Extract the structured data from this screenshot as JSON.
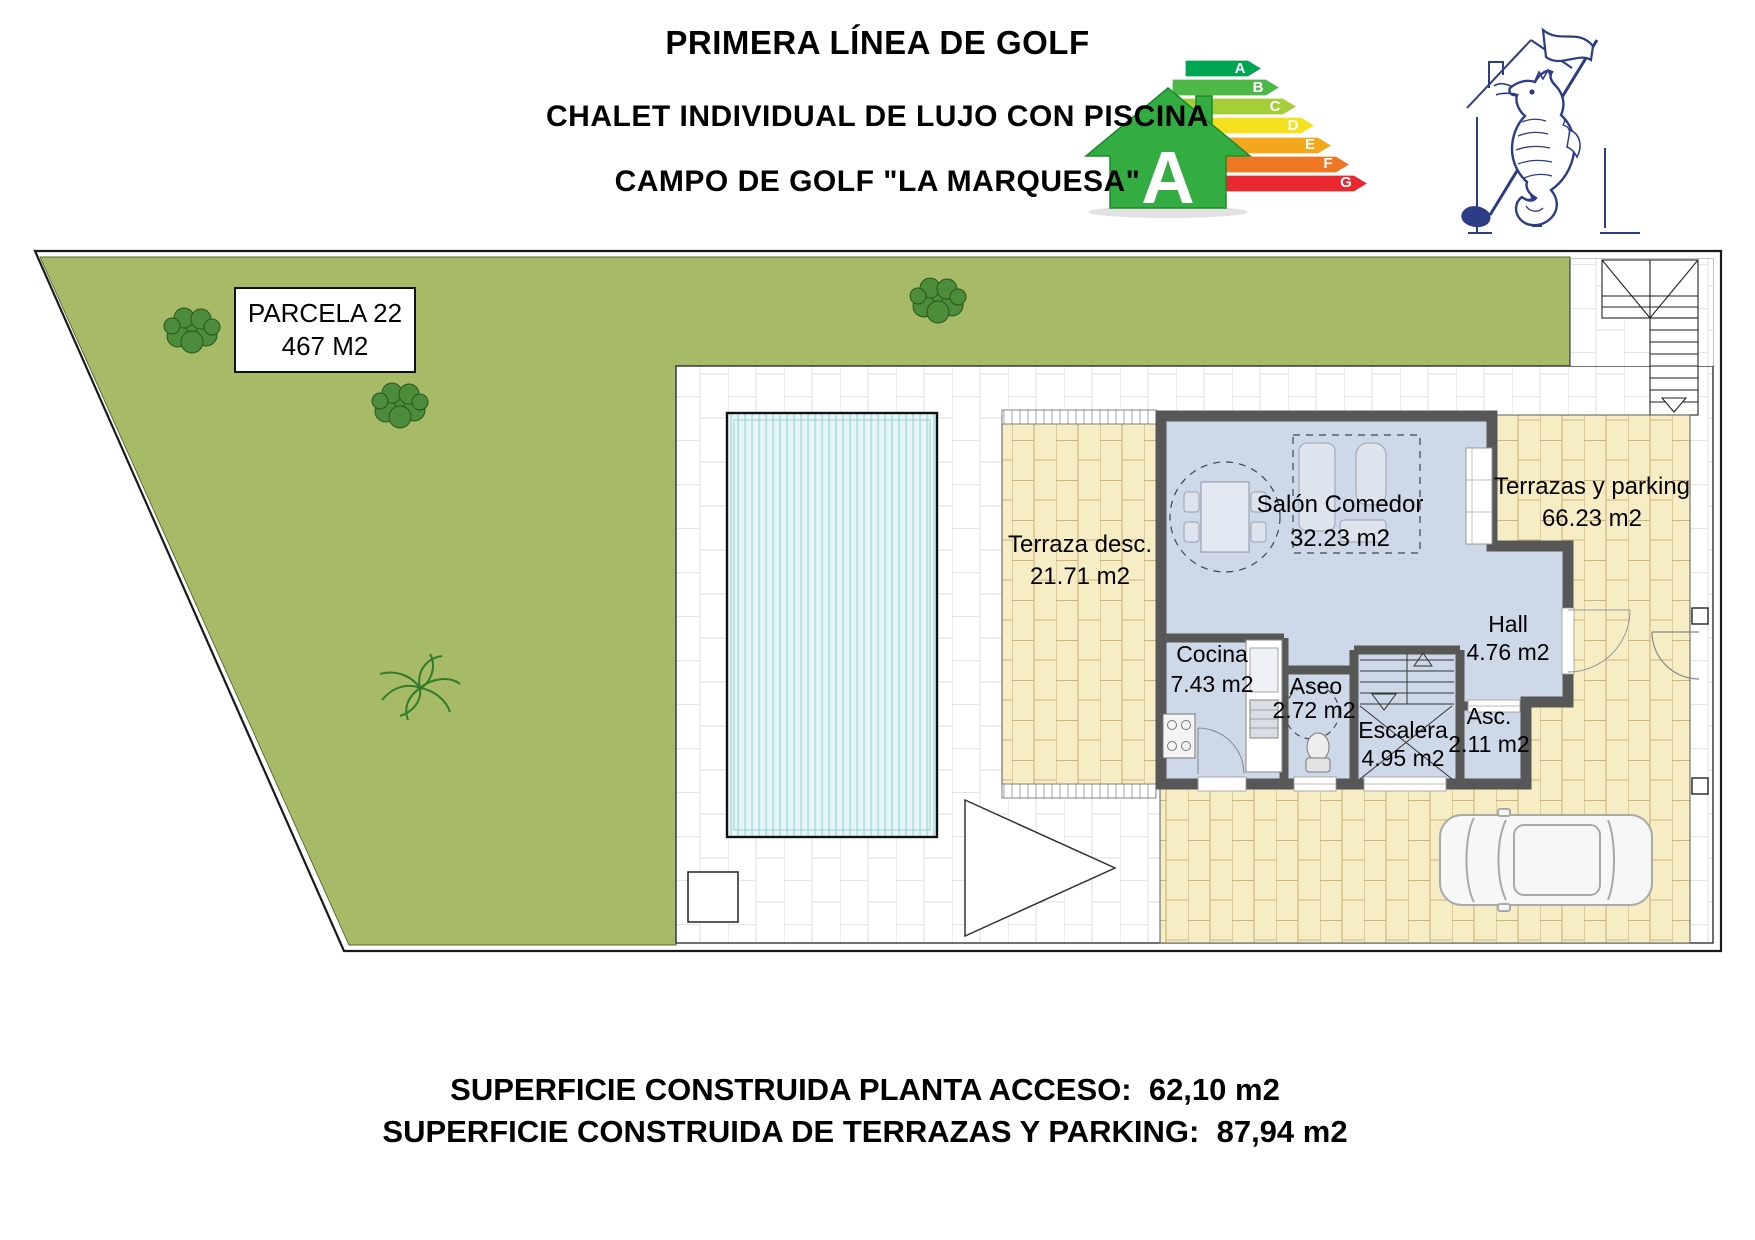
{
  "header": {
    "title_line1": "PRIMERA LÍNEA DE GOLF",
    "title_line2": "CHALET INDIVIDUAL DE LUJO CON PISCINA",
    "title_line3": "CAMPO DE GOLF \"LA MARQUESA\""
  },
  "energy_label": {
    "rating": "A",
    "bars": [
      {
        "label": "A",
        "color": "#00a551"
      },
      {
        "label": "B",
        "color": "#4db848"
      },
      {
        "label": "C",
        "color": "#a6ce39"
      },
      {
        "label": "D",
        "color": "#f4e01f"
      },
      {
        "label": "E",
        "color": "#f2a71d"
      },
      {
        "label": "F",
        "color": "#ef7622"
      },
      {
        "label": "G",
        "color": "#e8272e"
      }
    ],
    "house_color": "#33ac41"
  },
  "plan": {
    "parcel": {
      "name": "PARCELA 22",
      "area": "467 M2"
    },
    "rooms": {
      "terraza": {
        "name": "Terraza desc.",
        "area": "21.71 m2"
      },
      "salon": {
        "name": "Salón Comedor",
        "area": "32.23 m2"
      },
      "terrazas": {
        "name": "Terrazas y parking",
        "area": "66.23 m2"
      },
      "hall": {
        "name": "Hall",
        "area": "4.76 m2"
      },
      "cocina": {
        "name": "Cocina",
        "area": "7.43 m2"
      },
      "aseo": {
        "name": "Aseo",
        "area": "2.72 m2"
      },
      "escalera": {
        "name": "Escalera",
        "area": "4.95 m2"
      },
      "asc": {
        "name": "Asc.",
        "area": "2.11 m2"
      }
    },
    "colors": {
      "grass": "#a6ba68",
      "terrace_brick": "#f7edc5",
      "interior": "#cdd8e8",
      "wall": "#575757",
      "pool": "#e8f6f7"
    }
  },
  "footer": {
    "line1": "SUPERFICIE CONSTRUIDA PLANTA ACCESO:  62,10 m2",
    "line2": "SUPERFICIE CONSTRUIDA DE TERRAZAS Y PARKING:  87,94 m2"
  }
}
